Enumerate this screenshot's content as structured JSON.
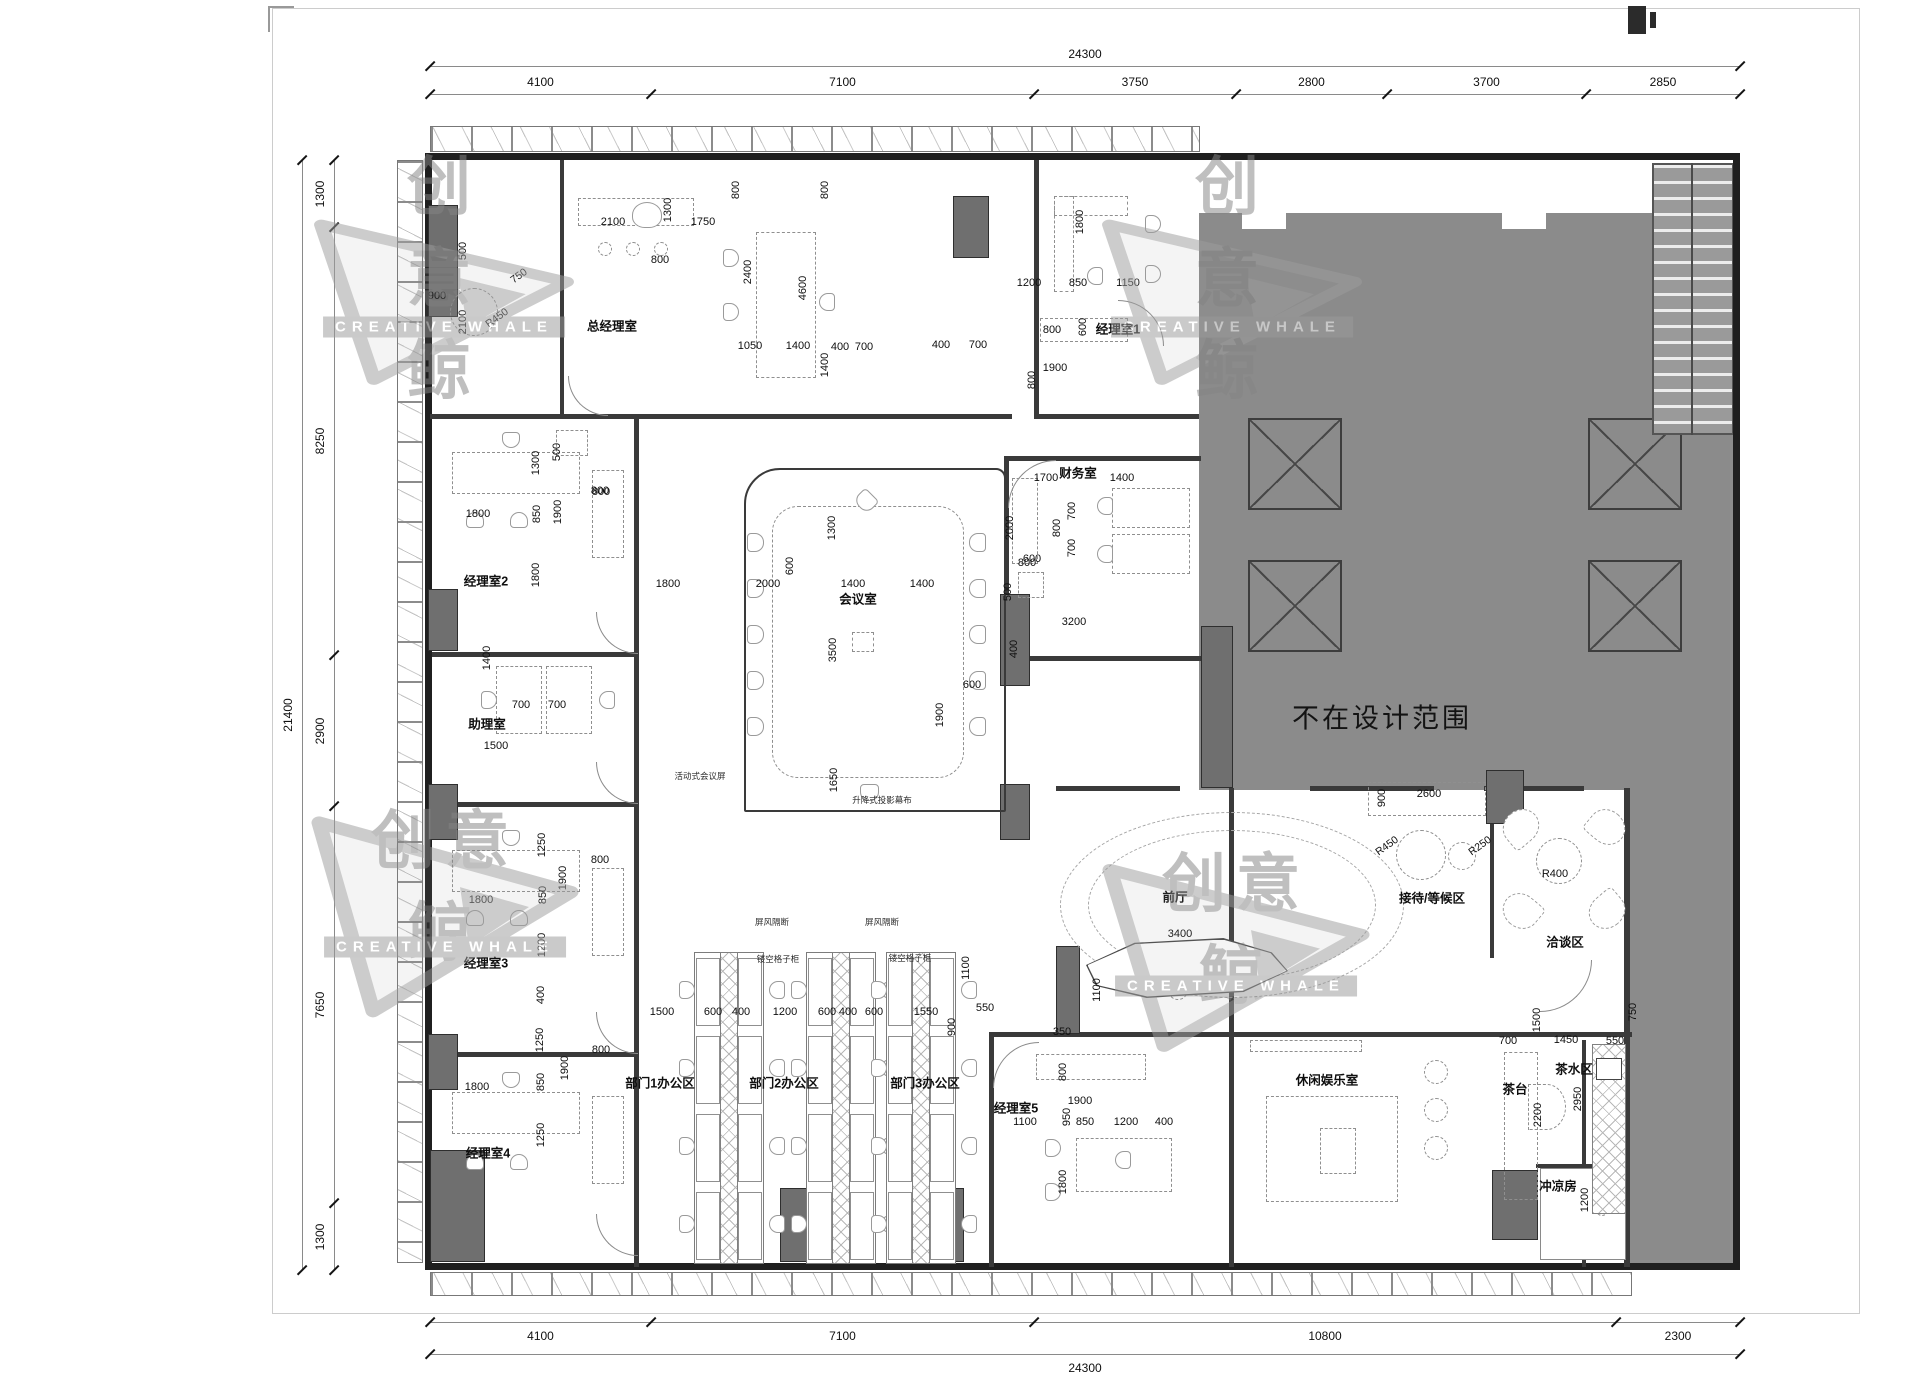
{
  "watermark": {
    "zh": "创意鲸",
    "en": "CREATIVE WHALE"
  },
  "colors": {
    "wall": "#1f1f1f",
    "gray_zone": "#8b8b8b",
    "pillar": "#6f6f6f",
    "furniture_line": "#8f8f8f",
    "dim_text": "#111111",
    "watermark": "#9e9e9e"
  },
  "dimensions": {
    "top": {
      "total": "24300",
      "segments": [
        "4100",
        "7100",
        "3750",
        "2800",
        "3700",
        "2850"
      ]
    },
    "bottom": {
      "total": "24300",
      "segments": [
        "4100",
        "7100",
        "10800",
        "2300"
      ]
    },
    "left": {
      "total": "21400",
      "segments": [
        "1300",
        "8250",
        "2900",
        "7650",
        "1300"
      ]
    }
  },
  "plan_texts": [
    {
      "t": "总经理室",
      "x": 612,
      "y": 325,
      "k": "r"
    },
    {
      "t": "经理室1",
      "x": 1118,
      "y": 328,
      "k": "r"
    },
    {
      "t": "财务室",
      "x": 1078,
      "y": 472,
      "k": "r"
    },
    {
      "t": "会议室",
      "x": 858,
      "y": 598,
      "k": "r"
    },
    {
      "t": "经理室2",
      "x": 486,
      "y": 580,
      "k": "r"
    },
    {
      "t": "助理室",
      "x": 487,
      "y": 723,
      "k": "r"
    },
    {
      "t": "经理室3",
      "x": 486,
      "y": 962,
      "k": "r"
    },
    {
      "t": "经理室4",
      "x": 488,
      "y": 1152,
      "k": "r"
    },
    {
      "t": "部门1办公区",
      "x": 660,
      "y": 1082,
      "k": "r"
    },
    {
      "t": "部门2办公区",
      "x": 784,
      "y": 1082,
      "k": "r"
    },
    {
      "t": "部门3办公区",
      "x": 925,
      "y": 1082,
      "k": "r"
    },
    {
      "t": "经理室5",
      "x": 1016,
      "y": 1107,
      "k": "r"
    },
    {
      "t": "前厅",
      "x": 1175,
      "y": 896,
      "k": "r"
    },
    {
      "t": "接待/等候区",
      "x": 1432,
      "y": 897,
      "k": "r"
    },
    {
      "t": "洽谈区",
      "x": 1565,
      "y": 941,
      "k": "r"
    },
    {
      "t": "休闲娱乐室",
      "x": 1327,
      "y": 1079,
      "k": "r"
    },
    {
      "t": "茶台",
      "x": 1515,
      "y": 1088,
      "k": "r"
    },
    {
      "t": "茶水区",
      "x": 1574,
      "y": 1068,
      "k": "r"
    },
    {
      "t": "冲凉房",
      "x": 1558,
      "y": 1185,
      "k": "r"
    },
    {
      "t": "不在设计范围",
      "x": 1382,
      "y": 716,
      "k": "b"
    },
    {
      "t": "活动式会议屏",
      "x": 700,
      "y": 776,
      "k": "n"
    },
    {
      "t": "升降式投影幕布",
      "x": 882,
      "y": 800,
      "k": "n"
    },
    {
      "t": "屏风隔断",
      "x": 772,
      "y": 922,
      "k": "n"
    },
    {
      "t": "屏风隔断",
      "x": 882,
      "y": 922,
      "k": "n"
    },
    {
      "t": "镂空格子柜",
      "x": 778,
      "y": 959,
      "k": "n"
    },
    {
      "t": "镂空格子柜",
      "x": 910,
      "y": 958,
      "k": "n"
    },
    {
      "t": "2100",
      "x": 613,
      "y": 222,
      "k": "d"
    },
    {
      "t": "1300",
      "x": 668,
      "y": 210,
      "k": "v"
    },
    {
      "t": "1750",
      "x": 703,
      "y": 222,
      "k": "d"
    },
    {
      "t": "800",
      "x": 736,
      "y": 190,
      "k": "v"
    },
    {
      "t": "800",
      "x": 825,
      "y": 190,
      "k": "v"
    },
    {
      "t": "800",
      "x": 660,
      "y": 260,
      "k": "d"
    },
    {
      "t": "2400",
      "x": 748,
      "y": 272,
      "k": "v"
    },
    {
      "t": "4600",
      "x": 803,
      "y": 288,
      "k": "v"
    },
    {
      "t": "1050",
      "x": 750,
      "y": 346,
      "k": "d"
    },
    {
      "t": "1400",
      "x": 798,
      "y": 346,
      "k": "d"
    },
    {
      "t": "400",
      "x": 840,
      "y": 347,
      "k": "d"
    },
    {
      "t": "700",
      "x": 864,
      "y": 347,
      "k": "d"
    },
    {
      "t": "900",
      "x": 437,
      "y": 296,
      "k": "d"
    },
    {
      "t": "500",
      "x": 463,
      "y": 251,
      "k": "v"
    },
    {
      "t": "750",
      "x": 519,
      "y": 276,
      "k": "g"
    },
    {
      "t": "R450",
      "x": 497,
      "y": 318,
      "k": "g"
    },
    {
      "t": "2100",
      "x": 463,
      "y": 322,
      "k": "v"
    },
    {
      "t": "1400",
      "x": 825,
      "y": 365,
      "k": "v"
    },
    {
      "t": "1800",
      "x": 1080,
      "y": 222,
      "k": "v"
    },
    {
      "t": "1200",
      "x": 1029,
      "y": 283,
      "k": "d"
    },
    {
      "t": "850",
      "x": 1078,
      "y": 283,
      "k": "d"
    },
    {
      "t": "1150",
      "x": 1128,
      "y": 283,
      "k": "d"
    },
    {
      "t": "800",
      "x": 1052,
      "y": 330,
      "k": "d"
    },
    {
      "t": "600",
      "x": 1083,
      "y": 327,
      "k": "v"
    },
    {
      "t": "400",
      "x": 941,
      "y": 345,
      "k": "d"
    },
    {
      "t": "700",
      "x": 978,
      "y": 345,
      "k": "d"
    },
    {
      "t": "1900",
      "x": 1055,
      "y": 368,
      "k": "d"
    },
    {
      "t": "800",
      "x": 1032,
      "y": 380,
      "k": "v"
    },
    {
      "t": "1700",
      "x": 1046,
      "y": 478,
      "k": "d"
    },
    {
      "t": "1400",
      "x": 1122,
      "y": 478,
      "k": "d"
    },
    {
      "t": "2000",
      "x": 1010,
      "y": 528,
      "k": "v"
    },
    {
      "t": "800",
      "x": 1057,
      "y": 528,
      "k": "v"
    },
    {
      "t": "700",
      "x": 1072,
      "y": 511,
      "k": "v"
    },
    {
      "t": "700",
      "x": 1072,
      "y": 548,
      "k": "v"
    },
    {
      "t": "600",
      "x": 1032,
      "y": 559,
      "k": "d"
    },
    {
      "t": "3200",
      "x": 1074,
      "y": 622,
      "k": "d"
    },
    {
      "t": "400",
      "x": 1014,
      "y": 649,
      "k": "v"
    },
    {
      "t": "500",
      "x": 1008,
      "y": 592,
      "k": "v"
    },
    {
      "t": "800",
      "x": 1027,
      "y": 563,
      "k": "d"
    },
    {
      "t": "1800",
      "x": 668,
      "y": 584,
      "k": "d"
    },
    {
      "t": "2000",
      "x": 768,
      "y": 584,
      "k": "d"
    },
    {
      "t": "1300",
      "x": 832,
      "y": 528,
      "k": "v"
    },
    {
      "t": "1400",
      "x": 853,
      "y": 584,
      "k": "d"
    },
    {
      "t": "1400",
      "x": 922,
      "y": 584,
      "k": "d"
    },
    {
      "t": "3500",
      "x": 833,
      "y": 650,
      "k": "v"
    },
    {
      "t": "1650",
      "x": 834,
      "y": 780,
      "k": "v"
    },
    {
      "t": "800",
      "x": 600,
      "y": 491,
      "k": "d"
    },
    {
      "t": "600",
      "x": 972,
      "y": 685,
      "k": "d"
    },
    {
      "t": "1900",
      "x": 940,
      "y": 715,
      "k": "v"
    },
    {
      "t": "600",
      "x": 790,
      "y": 566,
      "k": "v"
    },
    {
      "t": "1800",
      "x": 478,
      "y": 514,
      "k": "d"
    },
    {
      "t": "1300",
      "x": 536,
      "y": 463,
      "k": "v"
    },
    {
      "t": "850",
      "x": 537,
      "y": 514,
      "k": "v"
    },
    {
      "t": "1800",
      "x": 536,
      "y": 575,
      "k": "v"
    },
    {
      "t": "500",
      "x": 557,
      "y": 452,
      "k": "v"
    },
    {
      "t": "1900",
      "x": 558,
      "y": 512,
      "k": "v"
    },
    {
      "t": "800",
      "x": 601,
      "y": 492,
      "k": "d"
    },
    {
      "t": "1400",
      "x": 487,
      "y": 658,
      "k": "v"
    },
    {
      "t": "700",
      "x": 521,
      "y": 705,
      "k": "d"
    },
    {
      "t": "700",
      "x": 557,
      "y": 705,
      "k": "d"
    },
    {
      "t": "1500",
      "x": 496,
      "y": 746,
      "k": "d"
    },
    {
      "t": "1800",
      "x": 481,
      "y": 900,
      "k": "d"
    },
    {
      "t": "1250",
      "x": 542,
      "y": 845,
      "k": "v"
    },
    {
      "t": "850",
      "x": 543,
      "y": 895,
      "k": "v"
    },
    {
      "t": "1200",
      "x": 542,
      "y": 945,
      "k": "v"
    },
    {
      "t": "800",
      "x": 600,
      "y": 860,
      "k": "d"
    },
    {
      "t": "1900",
      "x": 563,
      "y": 878,
      "k": "v"
    },
    {
      "t": "400",
      "x": 541,
      "y": 995,
      "k": "v"
    },
    {
      "t": "1800",
      "x": 477,
      "y": 1087,
      "k": "d"
    },
    {
      "t": "1250",
      "x": 540,
      "y": 1040,
      "k": "v"
    },
    {
      "t": "850",
      "x": 541,
      "y": 1082,
      "k": "v"
    },
    {
      "t": "1250",
      "x": 541,
      "y": 1135,
      "k": "v"
    },
    {
      "t": "800",
      "x": 601,
      "y": 1050,
      "k": "d"
    },
    {
      "t": "1900",
      "x": 565,
      "y": 1068,
      "k": "v"
    },
    {
      "t": "1500",
      "x": 662,
      "y": 1012,
      "k": "d"
    },
    {
      "t": "600",
      "x": 713,
      "y": 1012,
      "k": "d"
    },
    {
      "t": "400",
      "x": 741,
      "y": 1012,
      "k": "d"
    },
    {
      "t": "1200",
      "x": 785,
      "y": 1012,
      "k": "d"
    },
    {
      "t": "600",
      "x": 827,
      "y": 1012,
      "k": "d"
    },
    {
      "t": "400",
      "x": 848,
      "y": 1012,
      "k": "d"
    },
    {
      "t": "600",
      "x": 874,
      "y": 1012,
      "k": "d"
    },
    {
      "t": "1550",
      "x": 926,
      "y": 1012,
      "k": "d"
    },
    {
      "t": "1100",
      "x": 966,
      "y": 968,
      "k": "v"
    },
    {
      "t": "550",
      "x": 985,
      "y": 1008,
      "k": "d"
    },
    {
      "t": "900",
      "x": 952,
      "y": 1027,
      "k": "v"
    },
    {
      "t": "800",
      "x": 1063,
      "y": 1072,
      "k": "v"
    },
    {
      "t": "1900",
      "x": 1080,
      "y": 1101,
      "k": "d"
    },
    {
      "t": "950",
      "x": 1067,
      "y": 1117,
      "k": "v"
    },
    {
      "t": "1100",
      "x": 1025,
      "y": 1122,
      "k": "d"
    },
    {
      "t": "850",
      "x": 1085,
      "y": 1122,
      "k": "d"
    },
    {
      "t": "1200",
      "x": 1126,
      "y": 1122,
      "k": "d"
    },
    {
      "t": "400",
      "x": 1164,
      "y": 1122,
      "k": "d"
    },
    {
      "t": "1800",
      "x": 1063,
      "y": 1182,
      "k": "v"
    },
    {
      "t": "3400",
      "x": 1180,
      "y": 934,
      "k": "d"
    },
    {
      "t": "900",
      "x": 1382,
      "y": 798,
      "k": "v"
    },
    {
      "t": "2600",
      "x": 1429,
      "y": 794,
      "k": "d"
    },
    {
      "t": "R450",
      "x": 1387,
      "y": 846,
      "k": "g"
    },
    {
      "t": "R250",
      "x": 1480,
      "y": 846,
      "k": "g"
    },
    {
      "t": "R400",
      "x": 1555,
      "y": 874,
      "k": "d"
    },
    {
      "t": "1100",
      "x": 1097,
      "y": 990,
      "k": "v"
    },
    {
      "t": "350",
      "x": 1062,
      "y": 1032,
      "k": "d"
    },
    {
      "t": "700",
      "x": 1508,
      "y": 1041,
      "k": "d"
    },
    {
      "t": "1500",
      "x": 1537,
      "y": 1020,
      "k": "v"
    },
    {
      "t": "1450",
      "x": 1566,
      "y": 1040,
      "k": "d"
    },
    {
      "t": "550",
      "x": 1615,
      "y": 1041,
      "k": "d"
    },
    {
      "t": "750",
      "x": 1633,
      "y": 1012,
      "k": "v"
    },
    {
      "t": "2200",
      "x": 1538,
      "y": 1115,
      "k": "v"
    },
    {
      "t": "2950",
      "x": 1578,
      "y": 1099,
      "k": "v"
    },
    {
      "t": "1200",
      "x": 1585,
      "y": 1200,
      "k": "v"
    }
  ]
}
